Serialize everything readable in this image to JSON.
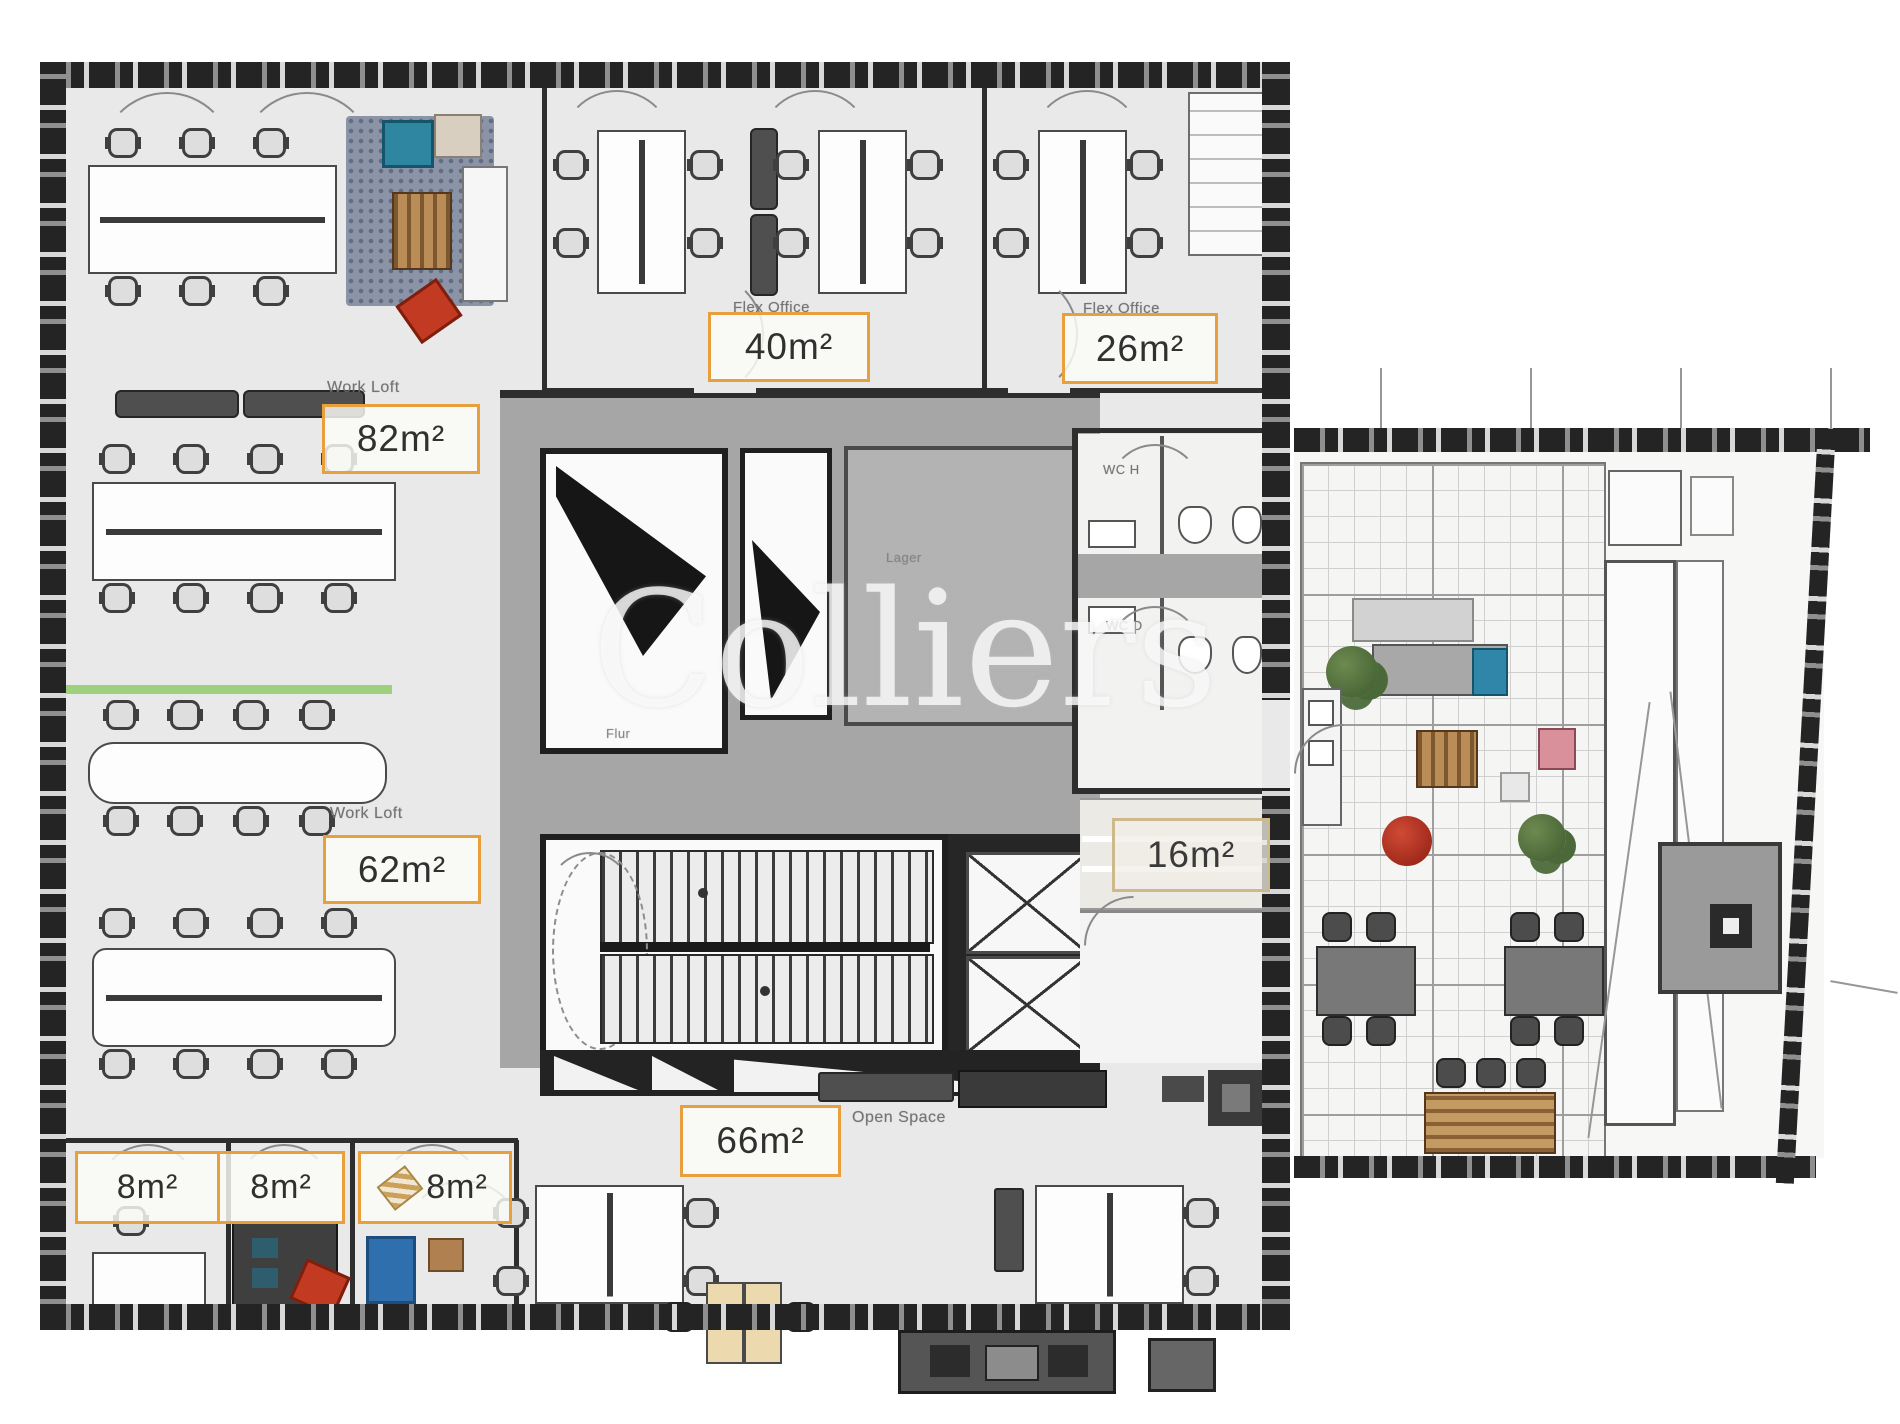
{
  "watermark": {
    "text": "Colliers"
  },
  "rooms": {
    "work_loft_top": {
      "label": "Work Loft",
      "area": "82m²"
    },
    "flex_office_left": {
      "label": "Flex Office",
      "area": "40m²"
    },
    "flex_office_right": {
      "label": "Flex Office",
      "area": "26m²"
    },
    "work_loft_bottom": {
      "label": "Work Loft",
      "area": "62m²"
    },
    "storage": {
      "label": "Lager"
    },
    "corridor": {
      "label": "Flur"
    },
    "wc_men": {
      "label": "WC H"
    },
    "wc_women": {
      "label": "WC D"
    },
    "meeting_16": {
      "area": "16m²"
    },
    "open_space": {
      "label": "Open Space",
      "area": "66m²"
    },
    "cell_left": {
      "area": "8m²"
    },
    "cell_middle": {
      "area": "8m²"
    },
    "cell_right": {
      "area": "8m²"
    }
  },
  "colors": {
    "area_box_border": "#E8A03C",
    "area_box_border_faded": "#CDB98C",
    "accent_red": "#C23A22",
    "accent_teal": "#2E86A0",
    "accent_blue": "#2F6FAE",
    "accent_pink": "#D9909A",
    "wood": "#A9814F",
    "plant_green": "#51683F",
    "highlight_green": "#9ED17E"
  }
}
